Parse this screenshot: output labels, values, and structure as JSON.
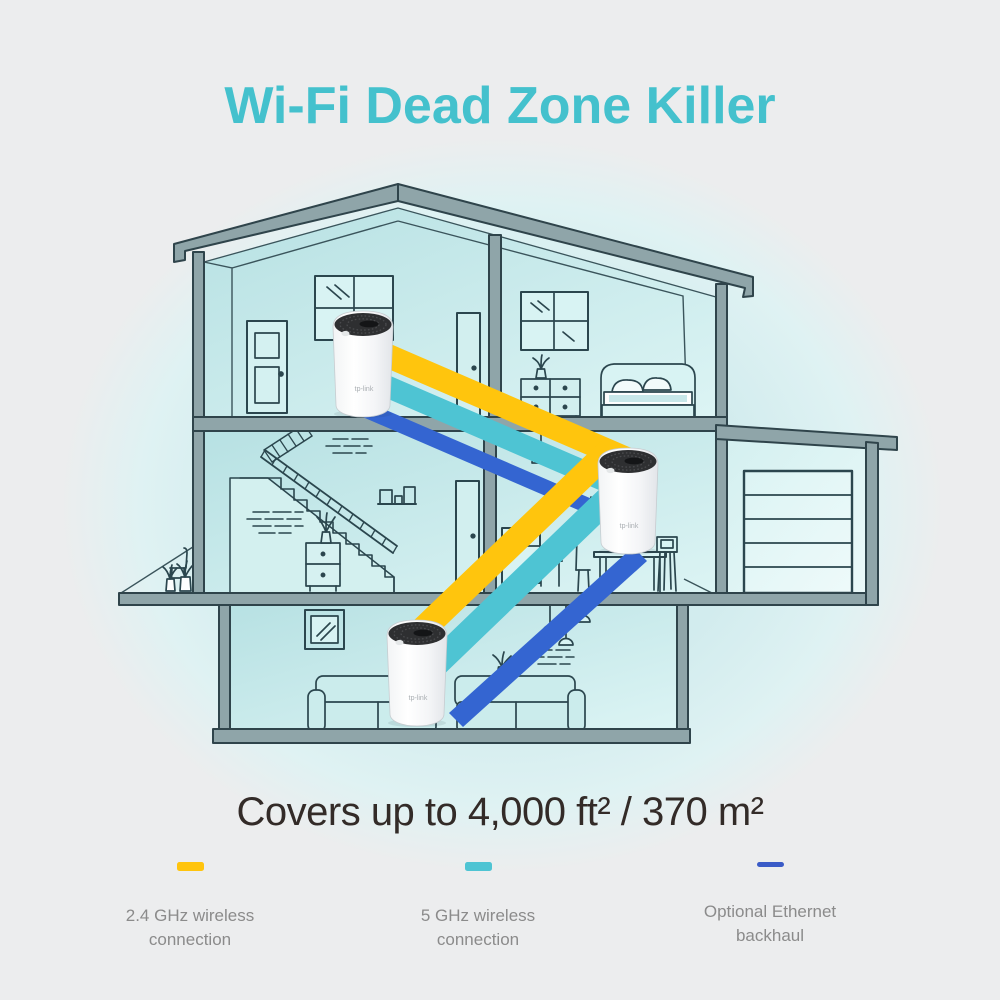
{
  "title": "Wi-Fi Dead Zone Killer",
  "coverage_text": "Covers up to 4,000 ft² / 370 m²",
  "legend": {
    "items": [
      {
        "line1": "2.4 GHz wireless",
        "line2": "connection",
        "color": "#FFC40D"
      },
      {
        "line1": "5 GHz wireless",
        "line2": "connection",
        "color": "#4EC4D3"
      },
      {
        "line1": "Optional Ethernet",
        "line2": "backhaul",
        "color": "#3A5BC7"
      }
    ]
  },
  "device": {
    "logo_text": "tp-link",
    "count": 3
  },
  "colors": {
    "background": "#ECEDEE",
    "title_text": "#44C1CD",
    "coverage_text": "#332B28",
    "legend_text": "#8B8B8B",
    "house_glow": "#D3ECEE",
    "structure_gray": "#8FA5A9",
    "outline_dark": "#2F444B",
    "interior_teal": "#C4E8E9",
    "beam_24ghz": "#FFC50D",
    "beam_5ghz": "#4EC4D3",
    "beam_ethernet": "#3465D1"
  }
}
